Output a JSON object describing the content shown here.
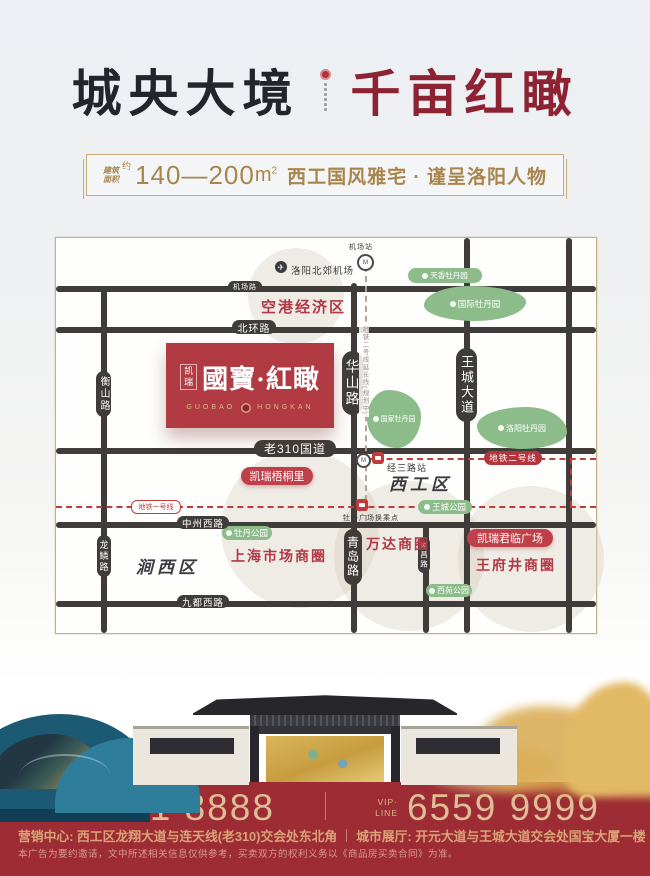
{
  "header": {
    "title_left": "城央大境",
    "title_right": "千亩红瞰",
    "banner": {
      "area_label_line1": "建筑",
      "area_label_line2": "面积",
      "approx": "约",
      "range": "140—200",
      "unit": "m",
      "unit_sup": "2",
      "tagline": "西工国风雅宅 · 谨呈洛阳人物"
    }
  },
  "map": {
    "airport": {
      "id": "luoyang-north-airport",
      "label": "洛阳北郊机场"
    },
    "stations": [
      {
        "id": "airport-station",
        "label": "机场站"
      },
      {
        "id": "jingsan-road-station",
        "label": "经三路站"
      },
      {
        "id": "mudan-square-transfer",
        "label": "牡丹广场换乘点"
      }
    ],
    "road_labels": [
      {
        "id": "jichang-road",
        "label": "机场路"
      },
      {
        "id": "beihuan-road",
        "label": "北环路"
      },
      {
        "id": "old-310-road",
        "label": "老310国道"
      },
      {
        "id": "zhongzhou-west-road",
        "label": "中州西路"
      },
      {
        "id": "jiudu-west-road",
        "label": "九都西路"
      },
      {
        "id": "hengshan-road",
        "label": "衡山路"
      },
      {
        "id": "longlin-road",
        "label": "龙鳞路"
      },
      {
        "id": "huashan-road",
        "label": "华山路"
      },
      {
        "id": "qingdao-road",
        "label": "青岛路"
      },
      {
        "id": "wangcheng-avenue",
        "label": "王城大道"
      },
      {
        "id": "nanchang-road",
        "label": "南昌路"
      }
    ],
    "metro": [
      {
        "id": "metro-line-1",
        "label": "地铁一号线"
      },
      {
        "id": "metro-line-2",
        "label": "地铁二号线"
      },
      {
        "id": "metro-line-2-extension",
        "label": "地铁二号线延长线(规划中)"
      }
    ],
    "parks": [
      {
        "id": "tianxiang-peony-garden",
        "label": "天香牡丹园"
      },
      {
        "id": "international-peony-garden",
        "label": "国际牡丹园"
      },
      {
        "id": "national-peony-garden",
        "label": "国家牡丹园"
      },
      {
        "id": "luoyang-peony-garden",
        "label": "洛阳牡丹园"
      },
      {
        "id": "wangcheng-park",
        "label": "王城公园"
      },
      {
        "id": "mudan-park",
        "label": "牡丹公园"
      },
      {
        "id": "xiyuan-park",
        "label": "西苑公园"
      }
    ],
    "zones": [
      {
        "id": "airport-economic-zone",
        "label": "空港经济区"
      },
      {
        "id": "shanghai-market-circle",
        "label": "上海市场商圈"
      },
      {
        "id": "wanda-circle",
        "label": "万达商圈"
      },
      {
        "id": "wangfujing-circle",
        "label": "王府井商圈"
      }
    ],
    "districts": [
      {
        "id": "xigong-district",
        "label": "西工区"
      },
      {
        "id": "jianxi-district",
        "label": "涧西区"
      }
    ],
    "projects": [
      {
        "id": "kairui-wutongli",
        "label": "凯瑞梧桐里"
      },
      {
        "id": "kairui-junlin-plaza",
        "label": "凯瑞君临广场"
      }
    ],
    "logo": {
      "brand": "凯瑞",
      "name": "國寶·紅瞰",
      "latin_left": "GUOBAO",
      "latin_right": "HONGKAN"
    }
  },
  "footer": {
    "vip_line1": "VIP·",
    "vip_line2": "LINE",
    "phone_left": "6221 8888",
    "phone_right": "6559 9999",
    "address_left": "营销中心: 西工区龙翔大道与连天线(老310)交会处东北角",
    "address_right": "城市展厅: 开元大道与王城大道交会处国宝大厦一楼",
    "disclaimer": "本广告为要约邀请，文中所述相关信息仅供参考，买卖双方的权利义务以《商品房买卖合同》为准。"
  },
  "colors": {
    "title_dark": "#23242c",
    "title_red": "#8d2332",
    "banner_gold": "#a9854e",
    "brand_red": "#b23a42",
    "footer_red": "#9e2c34",
    "park_green": "#8cbc8a",
    "metro_red": "#c23b3b",
    "road_dark": "#3f3c39"
  }
}
